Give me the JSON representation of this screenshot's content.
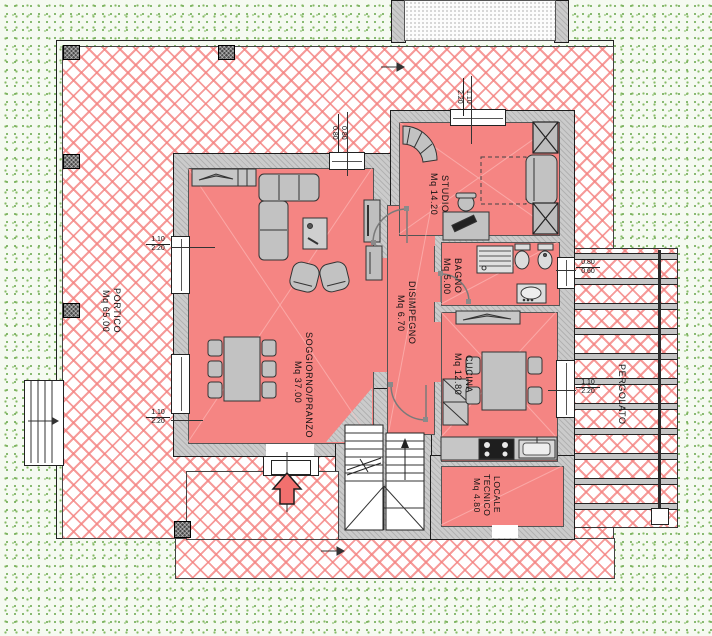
{
  "drawing": {
    "type": "architectural floor plan, ground floor",
    "rooms": {
      "soggiorno": {
        "name": "SOGGIORNO/PRANZO",
        "area": "Mq 37.00"
      },
      "studio": {
        "name": "STUDIO",
        "area": "Mq 14.20"
      },
      "bagno": {
        "name": "BAGNO",
        "area": "Mq 5.00"
      },
      "disimpegno": {
        "name": "DISIMPEGNO",
        "area": "Mq 6.70"
      },
      "cucina": {
        "name": "CUCINA",
        "area": "Mq 12.80"
      },
      "locale_tecnico": {
        "line1": "LOCALE",
        "line2": "TECNICO",
        "area": "Mq 4.80"
      },
      "portico": {
        "name": "PORTICO",
        "area": "Mq 65.00"
      },
      "pergolato": {
        "name": "PERGOLATO"
      }
    },
    "dimensions": {
      "window_west_upper": {
        "w": "1.10",
        "h": "2.20"
      },
      "window_west_lower": {
        "w": "1.10",
        "h": "2.20"
      },
      "window_north_soggiorno": {
        "w": "0.80",
        "h": "0.80"
      },
      "window_north_studio": {
        "w": "1.10",
        "h": "2.20"
      },
      "window_east_bagno": {
        "w": "0.80",
        "h": "0.60"
      },
      "window_east_cucina": {
        "w": "1.10",
        "h": "2.20"
      }
    },
    "colors": {
      "room_fill": "#f58583",
      "hatch_line": "#f48280",
      "wall_fill": "#cbcbcb",
      "column_fill": "#4a4a4a",
      "entrance_arrow": "#f2706e",
      "lawn_dot": "#6ba84e"
    }
  }
}
